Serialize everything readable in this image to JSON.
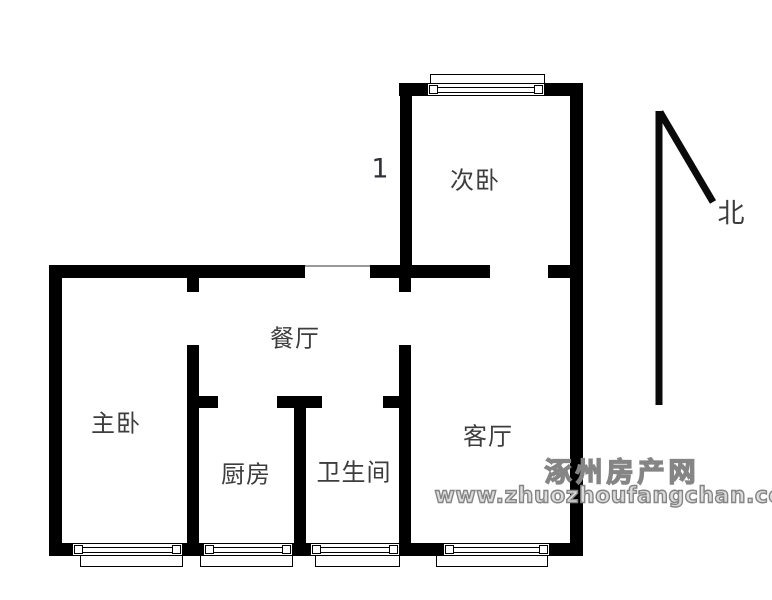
{
  "plan": {
    "rooms": [
      {
        "id": "secondary-bedroom",
        "label": "次卧"
      },
      {
        "id": "master-bedroom",
        "label": "主卧"
      },
      {
        "id": "dining-room",
        "label": "餐厅"
      },
      {
        "id": "kitchen",
        "label": "厨房"
      },
      {
        "id": "bathroom",
        "label": "卫生间"
      },
      {
        "id": "living-room",
        "label": "客厅"
      }
    ],
    "unit_number": "1",
    "compass": {
      "label": "北"
    }
  },
  "watermark": {
    "site_name": "涿州房产网",
    "site_url": "www.zhuozhoufangchan.com"
  },
  "colors": {
    "wall": "#000000",
    "background": "#ffffff",
    "label": "#3d3d3d",
    "watermark_fill": "#dcdcdc",
    "watermark_outline": "#858585"
  }
}
